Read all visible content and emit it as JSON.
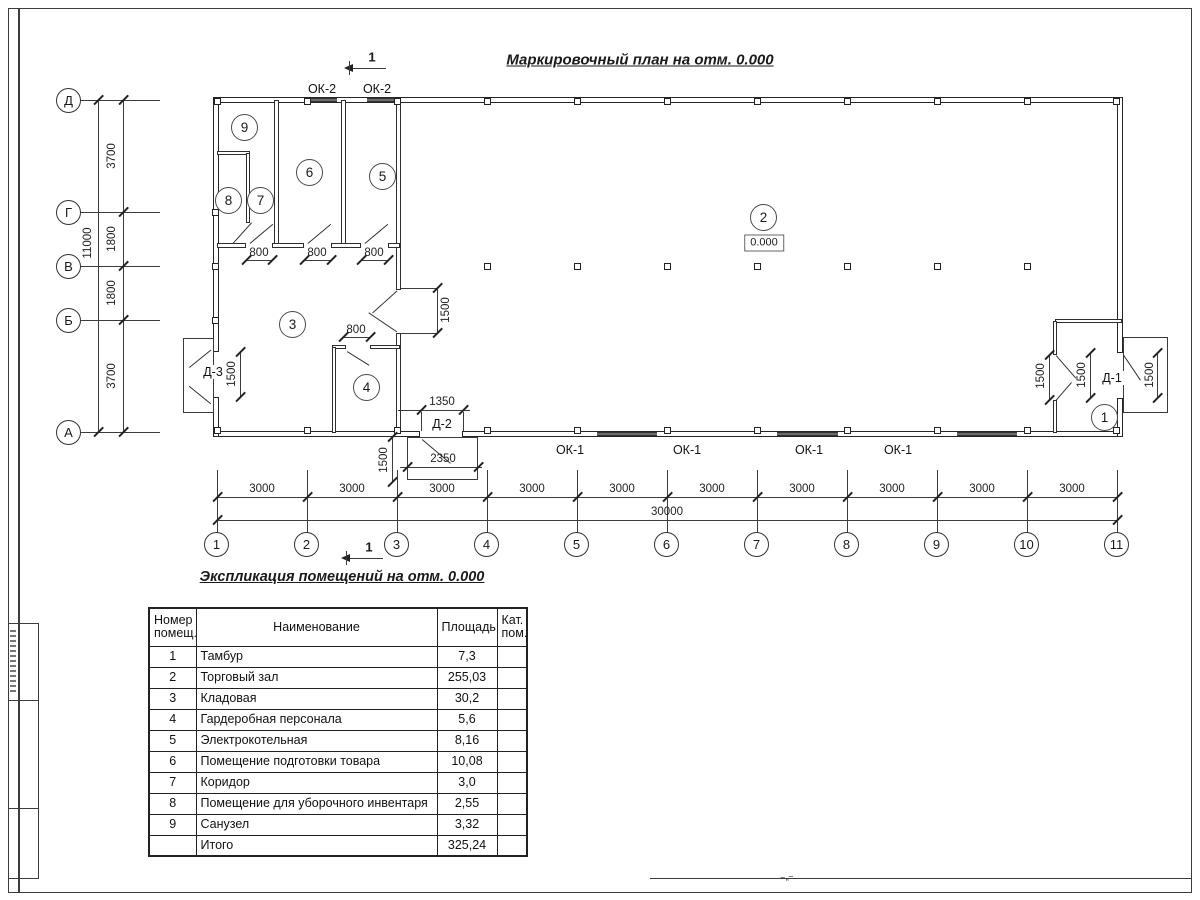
{
  "plan": {
    "title": "Маркировочный план на отм. 0.000",
    "section_label": "1",
    "elevation_value": "0.000",
    "room_numbers": [
      "1",
      "2",
      "3",
      "4",
      "5",
      "6",
      "7",
      "8",
      "9"
    ],
    "window_labels": {
      "top": [
        "ОК-2",
        "ОК-2"
      ],
      "bottom": [
        "ОК-1",
        "ОК-1",
        "ОК-1",
        "ОК-1"
      ]
    },
    "door_labels": {
      "d3": "Д-3",
      "d2": "Д-2",
      "d1": "Д-1"
    },
    "dims": {
      "openings_800": [
        "800",
        "800",
        "800",
        "800"
      ],
      "dims_1500": [
        "1500",
        "1500",
        "1500",
        "1500",
        "1500",
        "1500"
      ],
      "d2_width": "1350",
      "d2_porch_width": "2350"
    }
  },
  "axes": {
    "bottom": {
      "numbers": [
        "1",
        "2",
        "3",
        "4",
        "5",
        "6",
        "7",
        "8",
        "9",
        "10",
        "11"
      ],
      "segments": [
        "3000",
        "3000",
        "3000",
        "3000",
        "3000",
        "3000",
        "3000",
        "3000",
        "3000",
        "3000"
      ],
      "total": "30000"
    },
    "left": {
      "letters": [
        "Д",
        "Г",
        "В",
        "Б",
        "А"
      ],
      "segments": [
        "3700",
        "1800",
        "1800",
        "3700"
      ],
      "total": "11000"
    }
  },
  "explication": {
    "title": "Экспликация помещений на отм. 0.000",
    "headers": {
      "number": "Номер помещ.",
      "name": "Наименование",
      "area": "Площадь",
      "category": "Кат. пом."
    },
    "rows": [
      {
        "number": "1",
        "name": "Тамбур",
        "area": "7,3",
        "category": ""
      },
      {
        "number": "2",
        "name": "Торговый зал",
        "area": "255,03",
        "category": ""
      },
      {
        "number": "3",
        "name": "Кладовая",
        "area": "30,2",
        "category": ""
      },
      {
        "number": "4",
        "name": "Гардеробная персонала",
        "area": "5,6",
        "category": ""
      },
      {
        "number": "5",
        "name": "Электрокотельная",
        "area": "8,16",
        "category": ""
      },
      {
        "number": "6",
        "name": "Помещение подготовки товара",
        "area": "10,08",
        "category": ""
      },
      {
        "number": "7",
        "name": "Коридор",
        "area": "3,0",
        "category": ""
      },
      {
        "number": "8",
        "name": "Помещение для уборочного инвентаря",
        "area": "2,55",
        "category": ""
      },
      {
        "number": "9",
        "name": "Санузел",
        "area": "3,32",
        "category": ""
      }
    ],
    "total": {
      "name": "Итого",
      "area": "325,24"
    }
  }
}
